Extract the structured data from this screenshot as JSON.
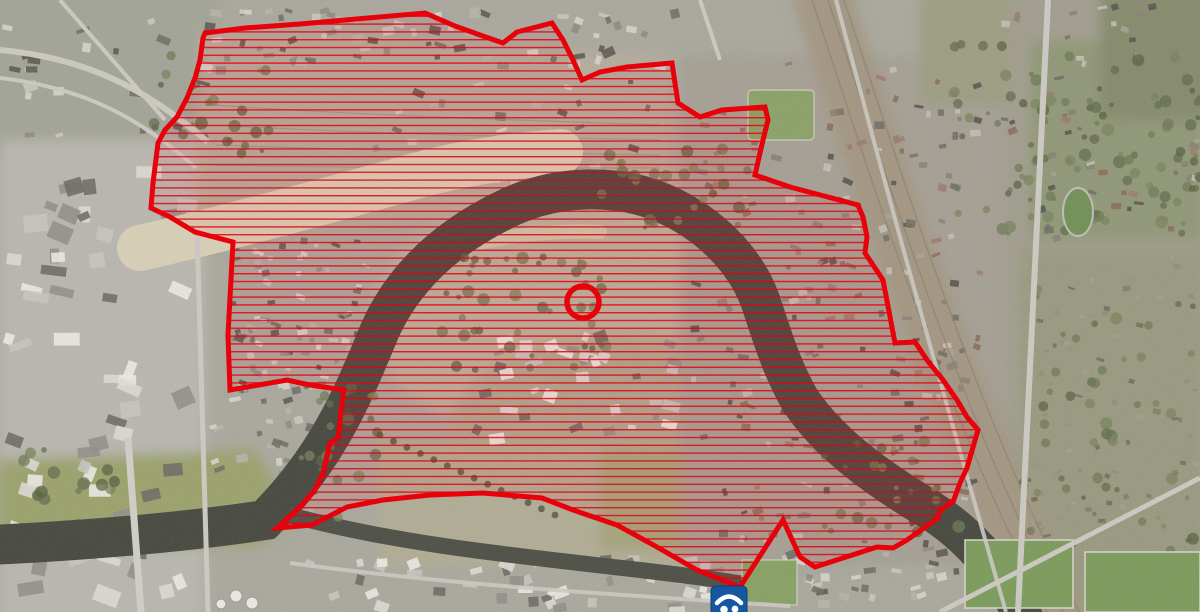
{
  "map": {
    "kind": "aerial-photograph-basemap",
    "palette": {
      "urban_base": "#a9a79c",
      "river_water": "#43453c",
      "sand_bank": "#d8cfb5",
      "meadow_green": "#9aa169",
      "park_green": "#8b9368"
    }
  },
  "overlay": {
    "evacuation_zone": {
      "outline_color": "#e8000a",
      "outline_width": 5,
      "hatch": {
        "color": "#e8000a",
        "spacing_px": 7.8,
        "line_width_px": 1.4,
        "line_opacity": 0.85,
        "wash_fill": "rgba(230,0,10,0.05)"
      },
      "polygon_points": "205,33 245,28 300,24 425,13 455,26 480,35 503,43 517,32 552,23 563,40 573,60 582,80 600,72 627,67 672,63 678,103 700,117 722,110 765,107 768,120 763,140 755,175 790,187 858,205 863,217 867,237 865,253 883,280 895,343 915,342 927,360 943,380 957,400 967,417 978,430 967,468 960,483 953,502 940,510 938,518 907,540 893,548 877,547 815,567 800,557 783,520 740,587 697,570 657,547 617,525 573,510 542,498 483,493 430,495 383,500 347,507 312,525 277,528 288,518 302,505 315,490 323,473 330,443 338,438 342,403 344,390 310,385 287,380 230,390 228,335 233,242 195,232 170,217 151,208 153,183 158,143 165,130 177,117 187,98 195,78 200,60 203,38"
    },
    "target_marker": {
      "shape": "circle",
      "cx": 583,
      "cy": 302,
      "r": 16,
      "stroke_color": "#e8000a",
      "stroke_width": 5.5
    },
    "shelter_marker": {
      "x": 711,
      "y": 586,
      "size": 36,
      "background": "#1558a0",
      "glyph": "roof-over-two-people",
      "glyph_color": "#ffffff"
    }
  }
}
